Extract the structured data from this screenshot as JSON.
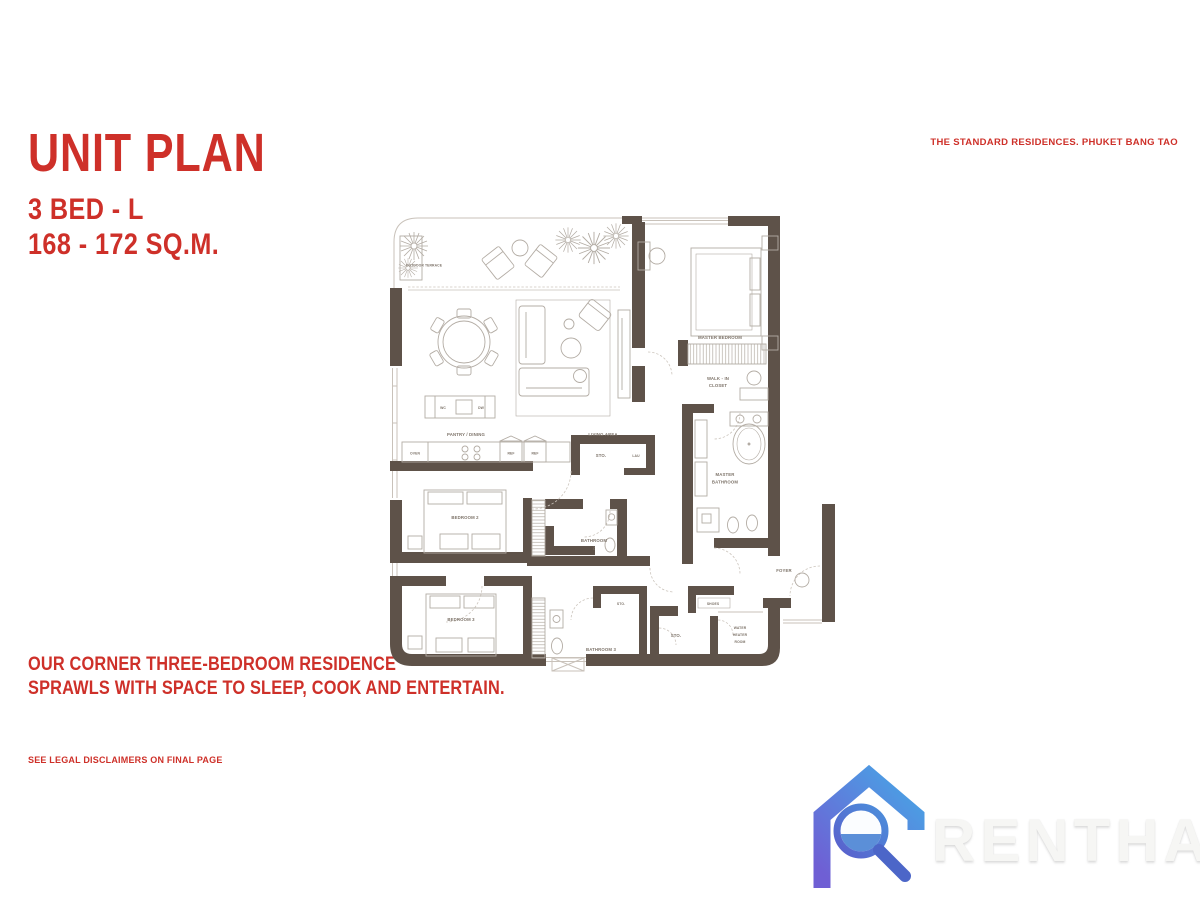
{
  "header": {
    "title": "UNIT PLAN",
    "unit_type": "3 BED - L",
    "area": "168 - 172  SQ.M.",
    "brand": "THE STANDARD RESIDENCES. PHUKET BANG TAO"
  },
  "description": {
    "line1": "OUR CORNER THREE-BEDROOM RESIDENCE",
    "line2": "SPRAWLS WITH SPACE TO SLEEP, COOK AND ENTERTAIN."
  },
  "footer": {
    "legal": "SEE LEGAL DISCLAIMERS ON FINAL PAGE"
  },
  "watermark": {
    "text": "RENTHAI"
  },
  "colors": {
    "accent_red": "#CE3029",
    "wall_brown": "#5E5249",
    "plan_line": "#B3ACA4",
    "logo_blue_light": "#4AA0E4",
    "logo_blue_dark": "#6F5FD4"
  },
  "floorplan": {
    "labels": {
      "outdoor_terrace": "OUTDOOR TERRACE",
      "pantry_dining": "PANTRY / DINING",
      "living_area": "LIVING AREA",
      "master_bedroom": "MASTER BEDROOM",
      "walk_in_1": "WALK - IN",
      "walk_in_2": "CLOSET",
      "master_bath_1": "MASTER",
      "master_bath_2": "BATHROOM",
      "bedroom2": "BEDROOM 2",
      "bedroom3": "BEDROOM 3",
      "bathroom2_1": "BATHROOM",
      "bathroom2_2": "2",
      "bathroom3": "BATHROOM 3",
      "oven": "OVEN",
      "wc": "WC",
      "dw": "DW",
      "ref": "REF",
      "sto": "STO.",
      "lau": "LAU",
      "shoes": "SHOES",
      "water_heater_1": "WATER",
      "water_heater_2": "HEATER",
      "water_heater_3": "ROOM",
      "foyer": "FOYER"
    }
  }
}
